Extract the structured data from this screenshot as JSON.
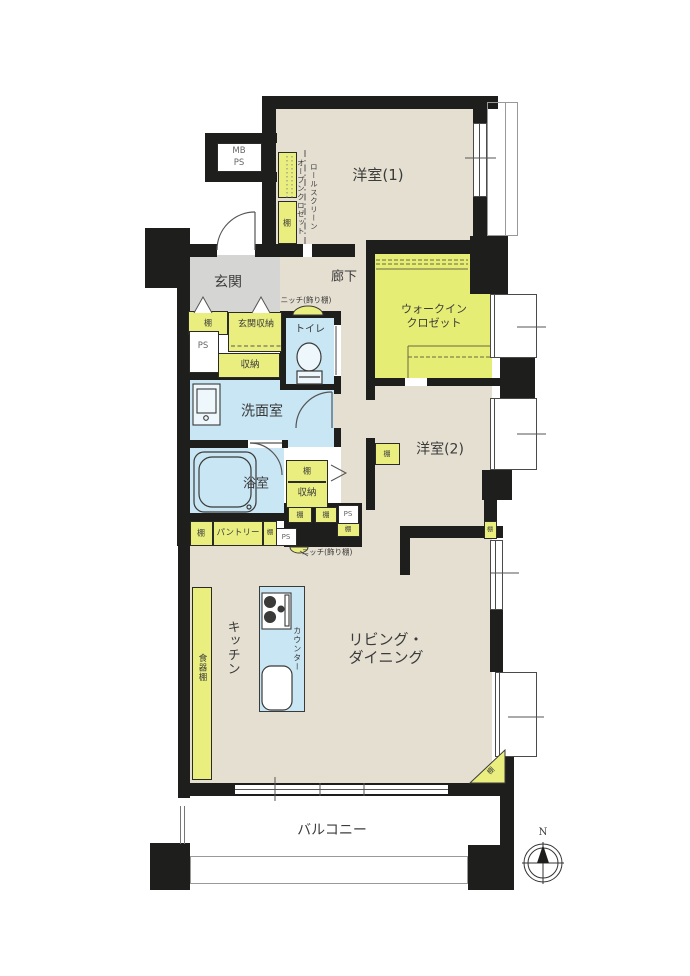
{
  "plan": {
    "rooms": {
      "western1": "洋室(1)",
      "western2": "洋室(2)",
      "entrance": "玄関",
      "corridor": "廊下",
      "wic_line1": "ウォークイン",
      "wic_line2": "クロゼット",
      "toilet": "トイレ",
      "washroom": "洗面室",
      "bathroom": "浴室",
      "living_line1": "リビング・",
      "living_line2": "ダイニング",
      "kitchen": "キッチン",
      "balcony": "バルコニー"
    },
    "fixtures": {
      "shelf": "棚",
      "storage": "収納",
      "entrance_storage": "玄関収納",
      "pantry": "パントリー",
      "cupboard": "食器棚",
      "counter": "カウンター",
      "ps": "PS",
      "mb": "MB",
      "niche": "ニッチ(飾り棚)",
      "roll_screen": "ロールスクリーン",
      "open_closet": "オープンクロゼット"
    },
    "compass": {
      "north": "N"
    },
    "colors": {
      "wall": "#1e1e1c",
      "floor": "#e5dfd1",
      "wet_area": "#c8e6f4",
      "closet": "#e9ee7f",
      "wic": "#e6ed74",
      "entrance_floor": "#d5d5d3"
    }
  }
}
